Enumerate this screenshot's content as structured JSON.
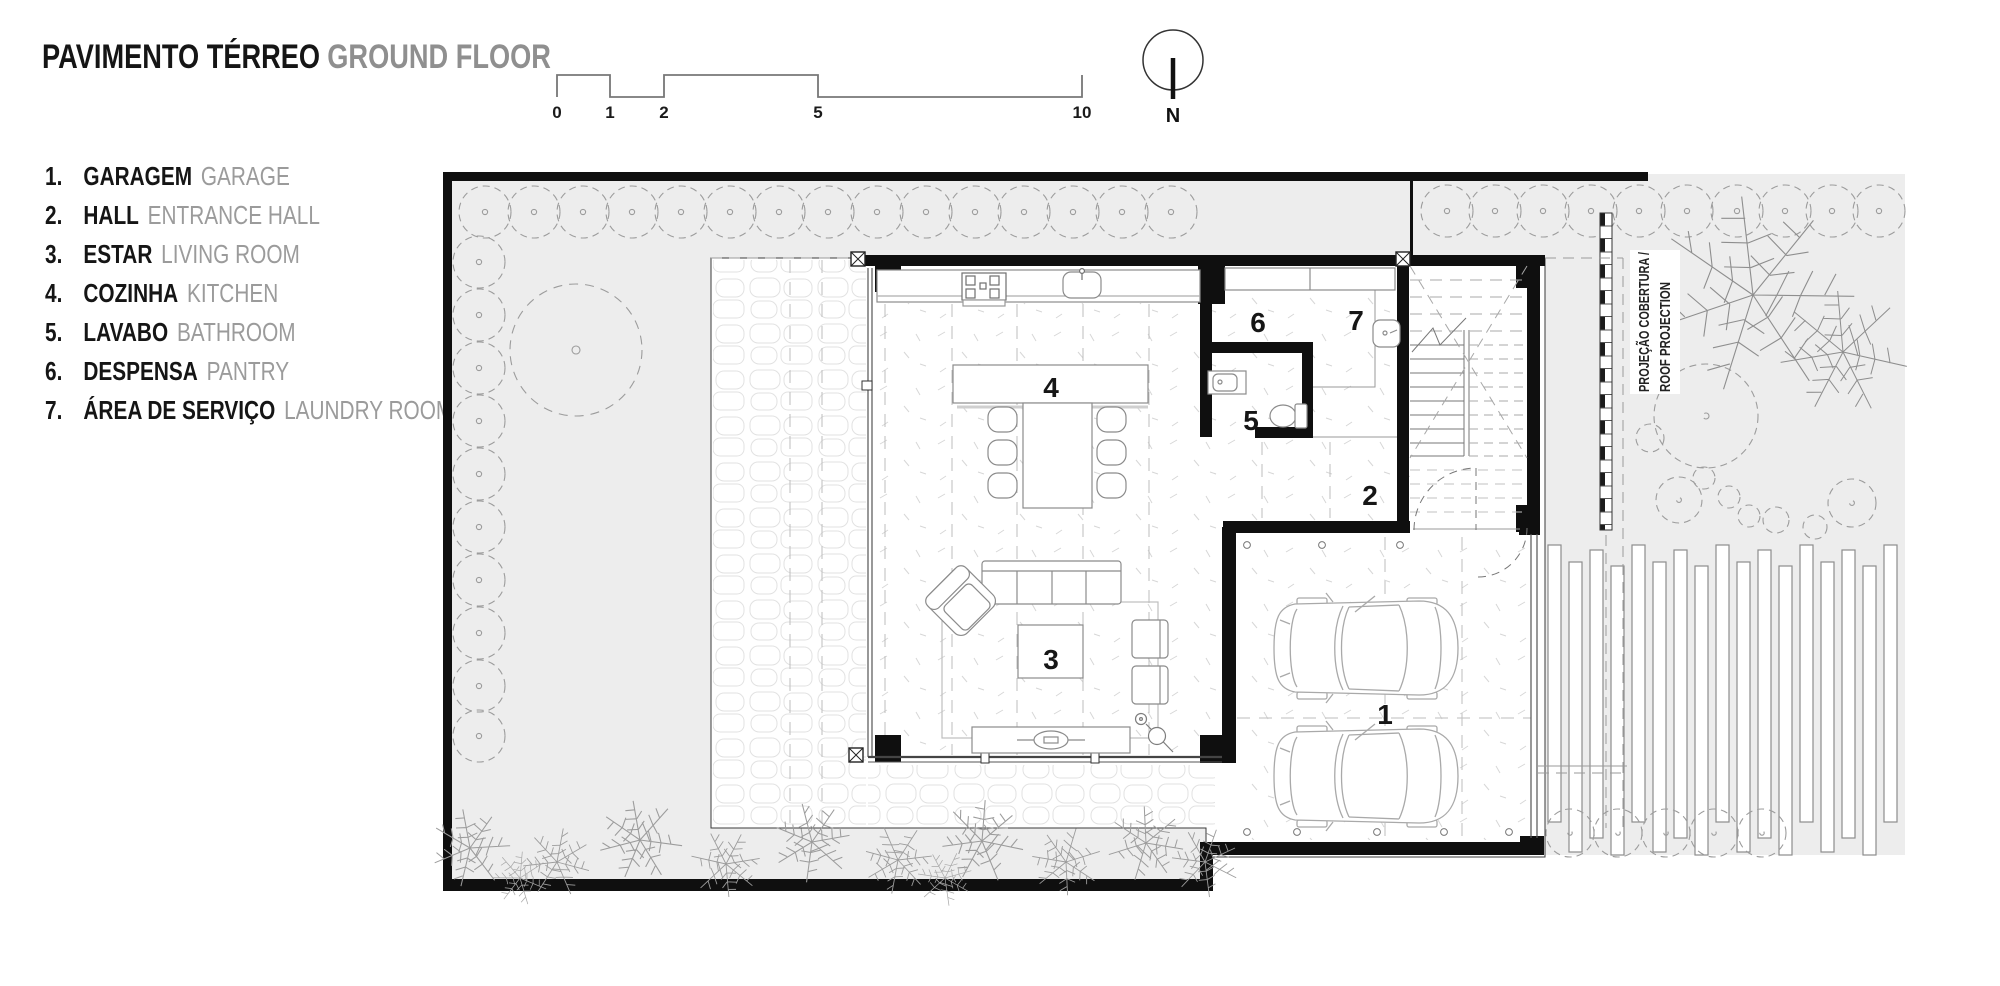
{
  "title": {
    "pt": "PAVIMENTO TÉRREO",
    "en": "GROUND FLOOR"
  },
  "legend": [
    {
      "num": "1.",
      "pt": "GARAGEM",
      "en": "GARAGE"
    },
    {
      "num": "2.",
      "pt": "HALL",
      "en": "ENTRANCE HALL"
    },
    {
      "num": "3.",
      "pt": "ESTAR",
      "en": "LIVING ROOM"
    },
    {
      "num": "4.",
      "pt": "COZINHA",
      "en": "KITCHEN"
    },
    {
      "num": "5.",
      "pt": "LAVABO",
      "en": "BATHROOM"
    },
    {
      "num": "6.",
      "pt": "DESPENSA",
      "en": "PANTRY"
    },
    {
      "num": "7.",
      "pt": "ÁREA DE SERVIÇO",
      "en": "LAUNDRY ROOM"
    }
  ],
  "scale_bar": {
    "labels": [
      "0",
      "1",
      "2",
      "5",
      "10"
    ]
  },
  "compass": {
    "label": "N"
  },
  "plan": {
    "rooms": {
      "garage": "1",
      "hall": "2",
      "living": "3",
      "kitchen": "4",
      "bathroom": "5",
      "pantry": "6",
      "laundry": "7"
    },
    "roof_projection": {
      "line1": "PROJEÇÃO COBERTURA /",
      "line2": "ROOF PROJECTION"
    }
  },
  "colors": {
    "site_fill": "#ededed",
    "wall": "#101010",
    "drawing_gray": "#9a9a9a",
    "text_gray": "#9b9b9b"
  }
}
